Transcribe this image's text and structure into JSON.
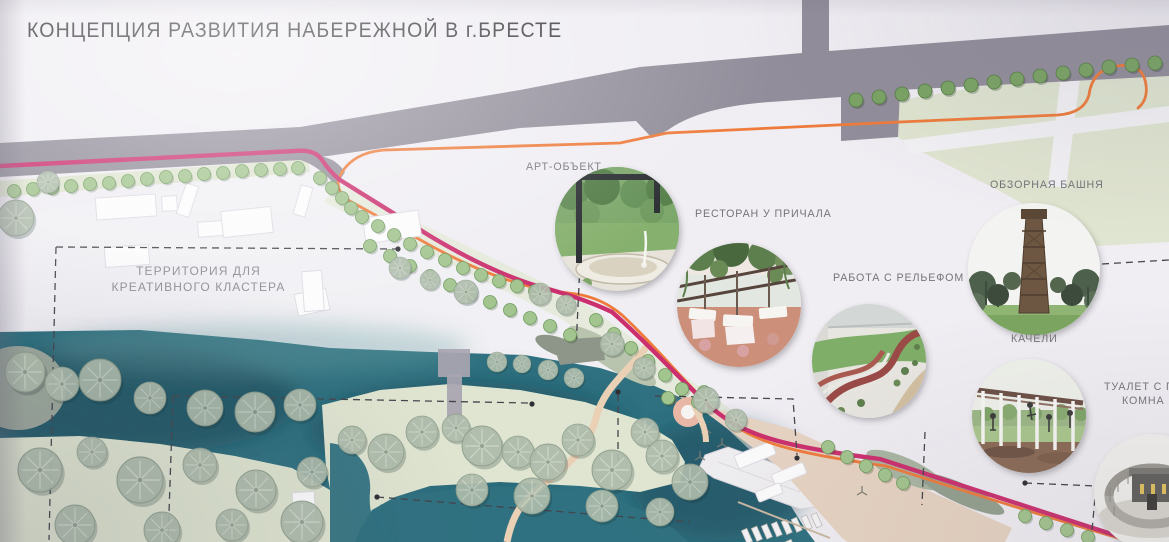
{
  "title": "КОНЦЕПЦИЯ РАЗВИТИЯ НАБЕРЕЖНОЙ В г.БРЕСТЕ",
  "map": {
    "territory_label": {
      "line1": "ТЕРРИТОРИЯ ДЛЯ",
      "line2": "КРЕАТИВНОГО КЛАСТЕРА"
    }
  },
  "callouts": [
    {
      "id": "art-object",
      "label": "АРТ-ОБЪЕКТ"
    },
    {
      "id": "restaurant-at-pier",
      "label": "РЕСТОРАН У ПРИЧАЛА"
    },
    {
      "id": "observation-tower",
      "label": "ОБЗОРНАЯ БАШНЯ"
    },
    {
      "id": "terrain-work",
      "label": "РАБОТА С РЕЛЬЕФОМ"
    },
    {
      "id": "swings",
      "label": "КАЧЕЛИ"
    },
    {
      "id": "toilet-with-changing-room",
      "label_line1": "ТУАЛЕТ С ПЕЛ",
      "label_line2": "КОМНА"
    }
  ],
  "colors": {
    "board": "#f0eef3",
    "road": "#918d9a",
    "water": "#2f7180",
    "grass": "#dfe5d0",
    "route_pink": "#cb2f6e",
    "route_orange": "#ee7b3b",
    "tree_green": "#a2c48e",
    "tree_dark_green": "#79a363",
    "tree_gray": "#aebcab",
    "path_tan": "#ead0b5",
    "promenade_tan": "#e6d3c2",
    "ink": "#3a3a3e",
    "label_gray": "#74747a"
  }
}
